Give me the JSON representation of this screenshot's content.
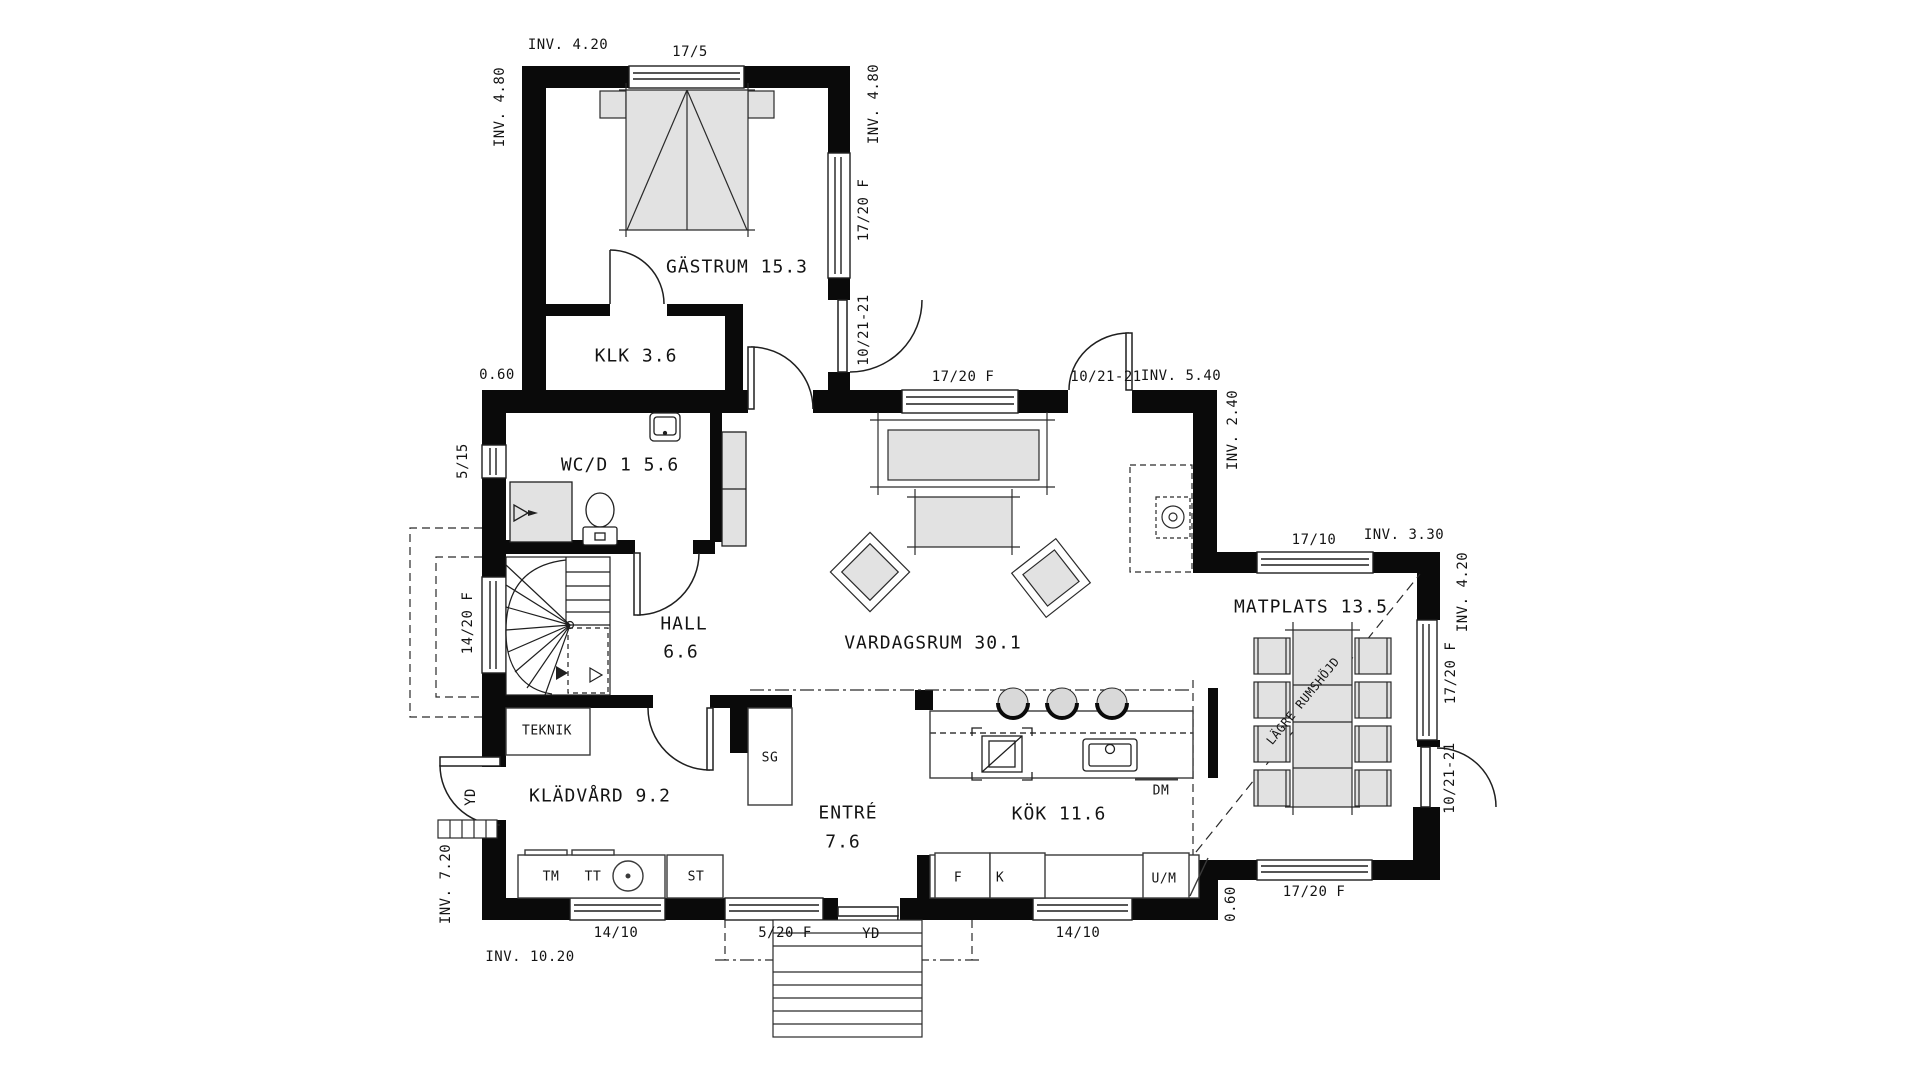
{
  "colors": {
    "wall": "#0a0a0a",
    "line": "#1f1f1f",
    "furniture_fill": "#e2e2e2",
    "background": "#ffffff"
  },
  "rooms": {
    "gastrum": "GÄSTRUM 15.3",
    "klk": "KLK 3.6",
    "wcd": "WC/D 1 5.6",
    "hall_name": "HALL",
    "hall_area": "6.6",
    "kladvard": "KLÄDVÅRD 9.2",
    "entre_name": "ENTRÉ",
    "entre_area": "7.6",
    "vardagsrum": "VARDAGSRUM 30.1",
    "kok": "KÖK 11.6",
    "matplats": "MATPLATS 13.5"
  },
  "fixtures": {
    "teknik": "TEKNIK",
    "sg": "SG",
    "tm": "TM",
    "tt": "TT",
    "st": "ST",
    "f": "F",
    "k": "K",
    "um": "U/M",
    "dm": "DM"
  },
  "dimensions": {
    "inv_420_top": "INV. 4.20",
    "inv_480_left": "INV. 4.80",
    "inv_480_right": "INV. 4.80",
    "offset_060_left": "0.60",
    "inv_720": "INV. 7.20",
    "inv_1020": "INV. 10.20",
    "inv_540": "INV. 5.40",
    "inv_240": "INV. 2.40",
    "inv_330": "INV. 3.30",
    "inv_420_right": "INV. 4.20",
    "offset_060_right": "0.60"
  },
  "openings": {
    "win_17_5": "17/5",
    "win_17_20f_gastrum": "17/20 F",
    "door_10_21_gastrum": "10/21-21",
    "win_5_15": "5/15",
    "win_14_20f": "14/20 F",
    "win_14_10_left": "14/10",
    "win_5_20f": "5/20 F",
    "yd_front": "YD",
    "yd_side": "YD",
    "win_17_20f_vardagsrum": "17/20 F",
    "door_10_21_vardagsrum": "10/21-21",
    "win_17_10": "17/10",
    "win_17_20f_matplats_east": "17/20 F",
    "door_10_21_matplats": "10/21-21",
    "win_17_20f_matplats_south": "17/20 F",
    "win_14_10_kok": "14/10"
  },
  "annotations": {
    "lagre_rumshojd": "LÄGRE RUMSHÖJD"
  }
}
